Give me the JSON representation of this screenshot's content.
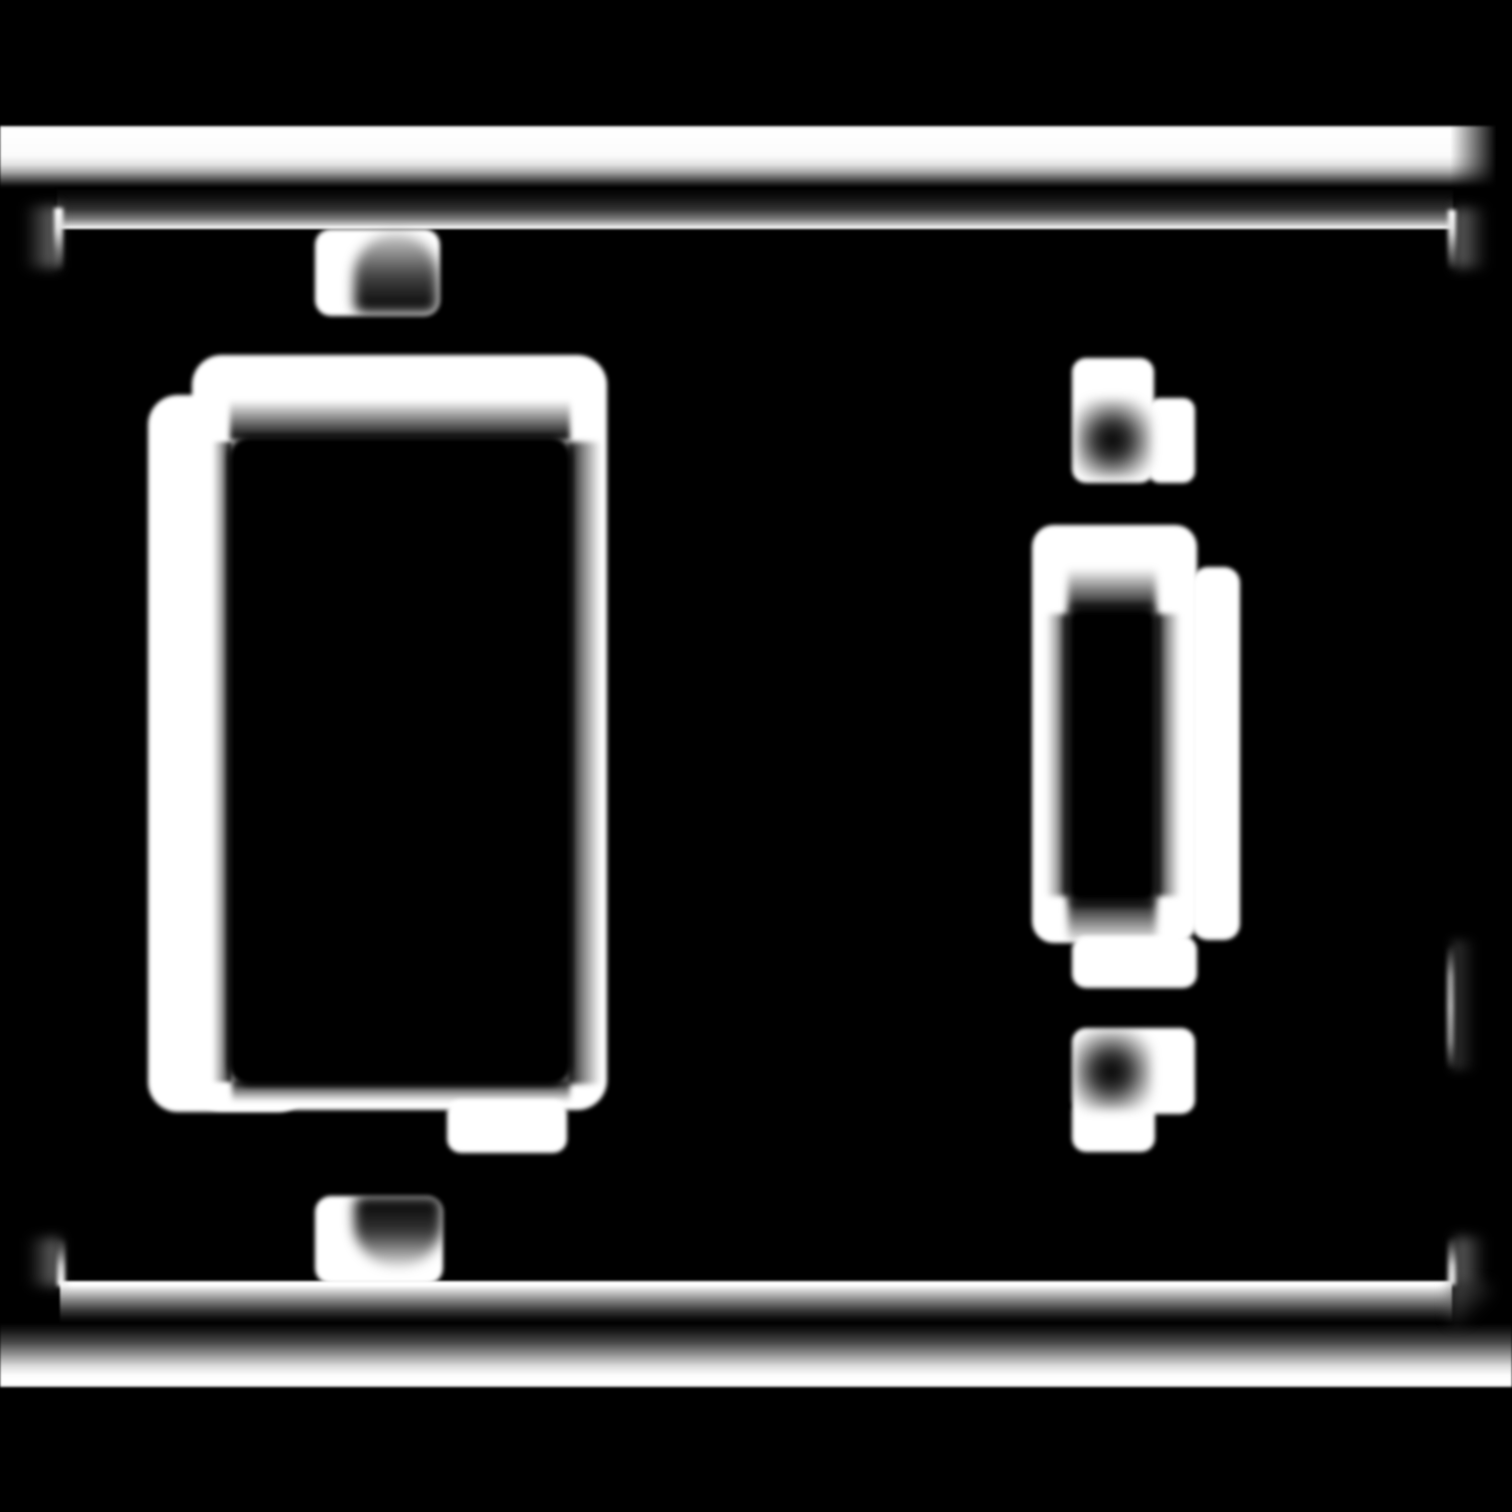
{
  "canvas": {
    "width_px": 1512,
    "height_px": 1512,
    "background_color": "#000000",
    "stroke_color": "#ffffff"
  },
  "figure": {
    "kind": "blurred white-on-black outline drawing of a two-gang switch wall plate",
    "left_opening": "large rocker-style rectangular opening with screw tabs above and below",
    "right_opening": "narrow toggle opening with screw tabs above and below",
    "regions": [
      {
        "name": "plate-top-edge-band",
        "x": 0,
        "y": 126,
        "w": 1512,
        "h": 62
      },
      {
        "name": "plate-top-band-right-fade",
        "x": 1450,
        "y": 120,
        "w": 62,
        "h": 75
      },
      {
        "name": "frame-top-line",
        "x": 57,
        "y": 188,
        "w": 1396,
        "h": 41
      },
      {
        "name": "frame-corner-tl-stub",
        "x": 54,
        "y": 208,
        "w": 9,
        "h": 66
      },
      {
        "name": "frame-corner-tl-halo",
        "x": 18,
        "y": 206,
        "w": 40,
        "h": 62
      },
      {
        "name": "frame-corner-tr-stub",
        "x": 1448,
        "y": 210,
        "w": 8,
        "h": 63
      },
      {
        "name": "frame-corner-tr-halo",
        "x": 1455,
        "y": 208,
        "w": 38,
        "h": 60
      },
      {
        "name": "frame-right-mid-segment",
        "x": 1447,
        "y": 945,
        "w": 7,
        "h": 124
      },
      {
        "name": "frame-right-mid-halo",
        "x": 1452,
        "y": 940,
        "w": 30,
        "h": 130
      },
      {
        "name": "frame-bottom-line",
        "x": 60,
        "y": 1281,
        "w": 1392,
        "h": 42
      },
      {
        "name": "frame-corner-bl-stub",
        "x": 57,
        "y": 1236,
        "w": 8,
        "h": 50
      },
      {
        "name": "frame-corner-bl-halo",
        "x": 22,
        "y": 1238,
        "w": 38,
        "h": 48
      },
      {
        "name": "frame-corner-br-stub",
        "x": 1448,
        "y": 1235,
        "w": 8,
        "h": 50
      },
      {
        "name": "frame-corner-br-halo",
        "x": 1455,
        "y": 1237,
        "w": 36,
        "h": 48
      },
      {
        "name": "frame-corner-br-smear",
        "x": 1450,
        "y": 1284,
        "w": 42,
        "h": 40
      },
      {
        "name": "plate-bottom-edge-band",
        "x": 0,
        "y": 1323,
        "w": 1512,
        "h": 64
      },
      {
        "name": "rocker-outline-main",
        "x": 192,
        "y": 355,
        "w": 415,
        "h": 755
      },
      {
        "name": "rocker-outline-offset",
        "x": 148,
        "y": 395,
        "w": 160,
        "h": 717
      },
      {
        "name": "rocker-inner-opening",
        "x": 228,
        "y": 436,
        "w": 344,
        "h": 650
      },
      {
        "name": "rocker-smear-top",
        "x": 230,
        "y": 400,
        "w": 340,
        "h": 40
      },
      {
        "name": "rocker-smear-right",
        "x": 567,
        "y": 442,
        "w": 34,
        "h": 642
      },
      {
        "name": "rocker-smear-bottom",
        "x": 232,
        "y": 1080,
        "w": 338,
        "h": 22
      },
      {
        "name": "rocker-smear-left",
        "x": 212,
        "y": 442,
        "w": 20,
        "h": 640
      },
      {
        "name": "rocker-screw-top-tab",
        "x": 315,
        "y": 229,
        "w": 125,
        "h": 87
      },
      {
        "name": "rocker-screw-top-hole",
        "x": 354,
        "y": 234,
        "w": 84,
        "h": 79
      },
      {
        "name": "rocker-screw-bottom-tab",
        "x": 315,
        "y": 1196,
        "w": 128,
        "h": 88
      },
      {
        "name": "rocker-screw-bottom-hole",
        "x": 354,
        "y": 1196,
        "w": 88,
        "h": 70
      },
      {
        "name": "rocker-bottom-small-tab",
        "x": 447,
        "y": 1100,
        "w": 120,
        "h": 53
      },
      {
        "name": "toggle-screw-top-tab",
        "x": 1072,
        "y": 358,
        "w": 82,
        "h": 125
      },
      {
        "name": "toggle-screw-top-step",
        "x": 1148,
        "y": 398,
        "w": 47,
        "h": 85
      },
      {
        "name": "toggle-screw-top-hole",
        "x": 1076,
        "y": 399,
        "w": 76,
        "h": 79
      },
      {
        "name": "toggle-outline-main",
        "x": 1032,
        "y": 525,
        "w": 165,
        "h": 418
      },
      {
        "name": "toggle-outline-step",
        "x": 1192,
        "y": 567,
        "w": 48,
        "h": 373
      },
      {
        "name": "toggle-inner-opening",
        "x": 1066,
        "y": 606,
        "w": 92,
        "h": 298
      },
      {
        "name": "toggle-smear-top",
        "x": 1068,
        "y": 568,
        "w": 88,
        "h": 44
      },
      {
        "name": "toggle-smear-bottom",
        "x": 1068,
        "y": 898,
        "w": 88,
        "h": 46
      },
      {
        "name": "toggle-smear-left",
        "x": 1046,
        "y": 614,
        "w": 24,
        "h": 282
      },
      {
        "name": "toggle-smear-right",
        "x": 1154,
        "y": 614,
        "w": 26,
        "h": 282
      },
      {
        "name": "toggle-bottom-tab",
        "x": 1072,
        "y": 936,
        "w": 125,
        "h": 52
      },
      {
        "name": "toggle-screw-bottom-main",
        "x": 1072,
        "y": 1028,
        "w": 123,
        "h": 86
      },
      {
        "name": "toggle-screw-bottom-step",
        "x": 1072,
        "y": 1098,
        "w": 83,
        "h": 54
      },
      {
        "name": "toggle-screw-bottom-hole",
        "x": 1074,
        "y": 1030,
        "w": 78,
        "h": 80
      }
    ]
  }
}
